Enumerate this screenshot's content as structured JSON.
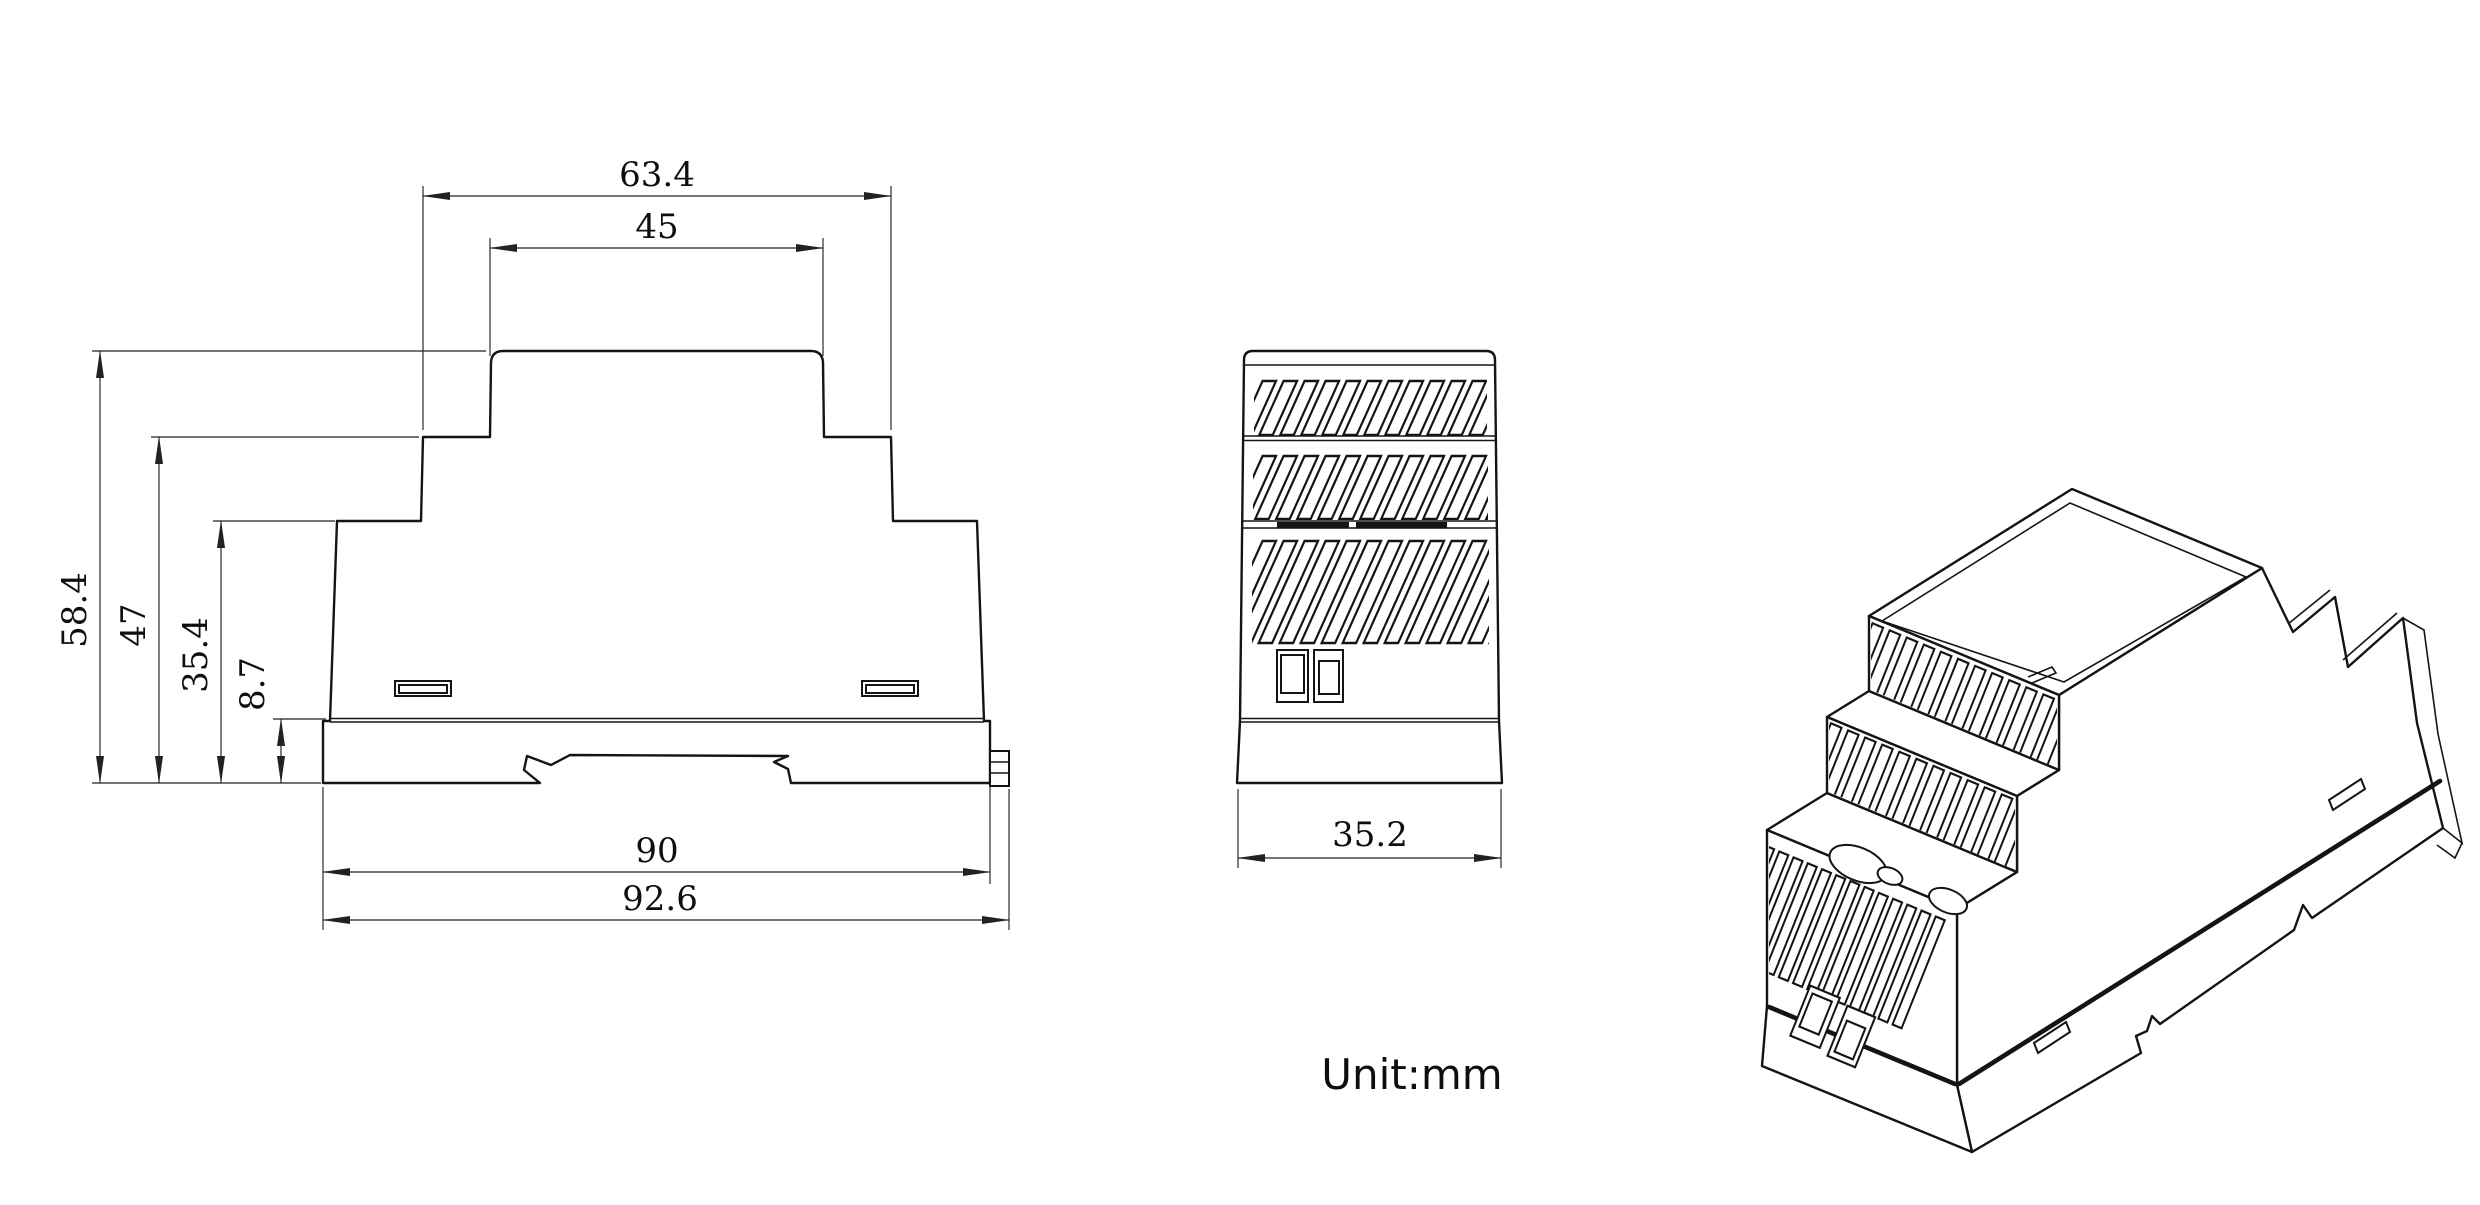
{
  "unit_note": "Unit:mm",
  "dimensions": {
    "front": {
      "top_width": "63.4",
      "cap_width": "45",
      "total_height": "58.4",
      "upper_step_height": "47",
      "lower_step_height": "35.4",
      "base_height": "8.7",
      "body_width": "90",
      "overall_width": "92.6"
    },
    "side": {
      "depth": "35.2"
    }
  }
}
